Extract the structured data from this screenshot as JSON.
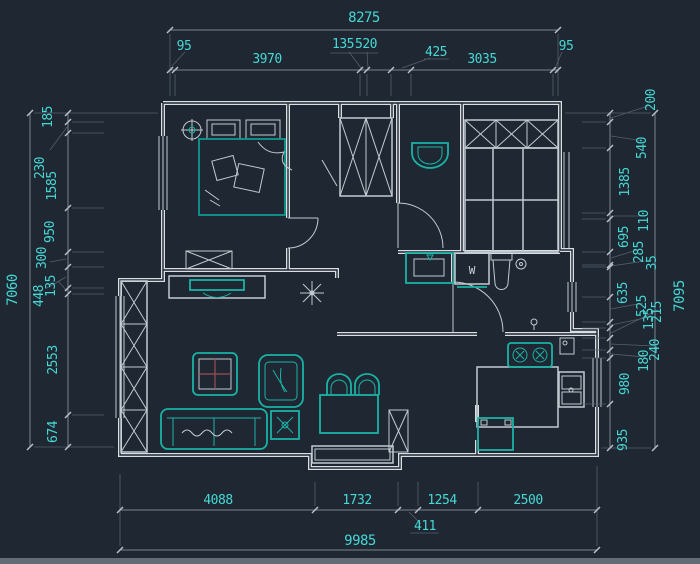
{
  "colors": {
    "background": "#1f2732",
    "dimension_text": "#46d8d5",
    "wall": "#d9dee3",
    "furniture_teal": "#19b3a6",
    "dim_line": "#77848f"
  },
  "dims": {
    "top": {
      "overall": "8275",
      "segments": [
        "95",
        "3970",
        "135",
        "520",
        "425",
        "3035",
        "95"
      ]
    },
    "left": {
      "overall": "7060",
      "segments": [
        "185",
        "230",
        "1585",
        "950",
        "300",
        "448",
        "135",
        "2553",
        "674"
      ]
    },
    "right": {
      "overall": "7095",
      "segments": [
        "200",
        "540",
        "1385",
        "110",
        "695",
        "285",
        "35",
        "635",
        "525",
        "135",
        "215",
        "240",
        "180",
        "980",
        "935"
      ]
    },
    "bottom": {
      "overall": "9985",
      "segments": [
        "4088",
        "1732",
        "411",
        "1254",
        "2500"
      ]
    }
  },
  "plan": {
    "washer_label": "W"
  }
}
